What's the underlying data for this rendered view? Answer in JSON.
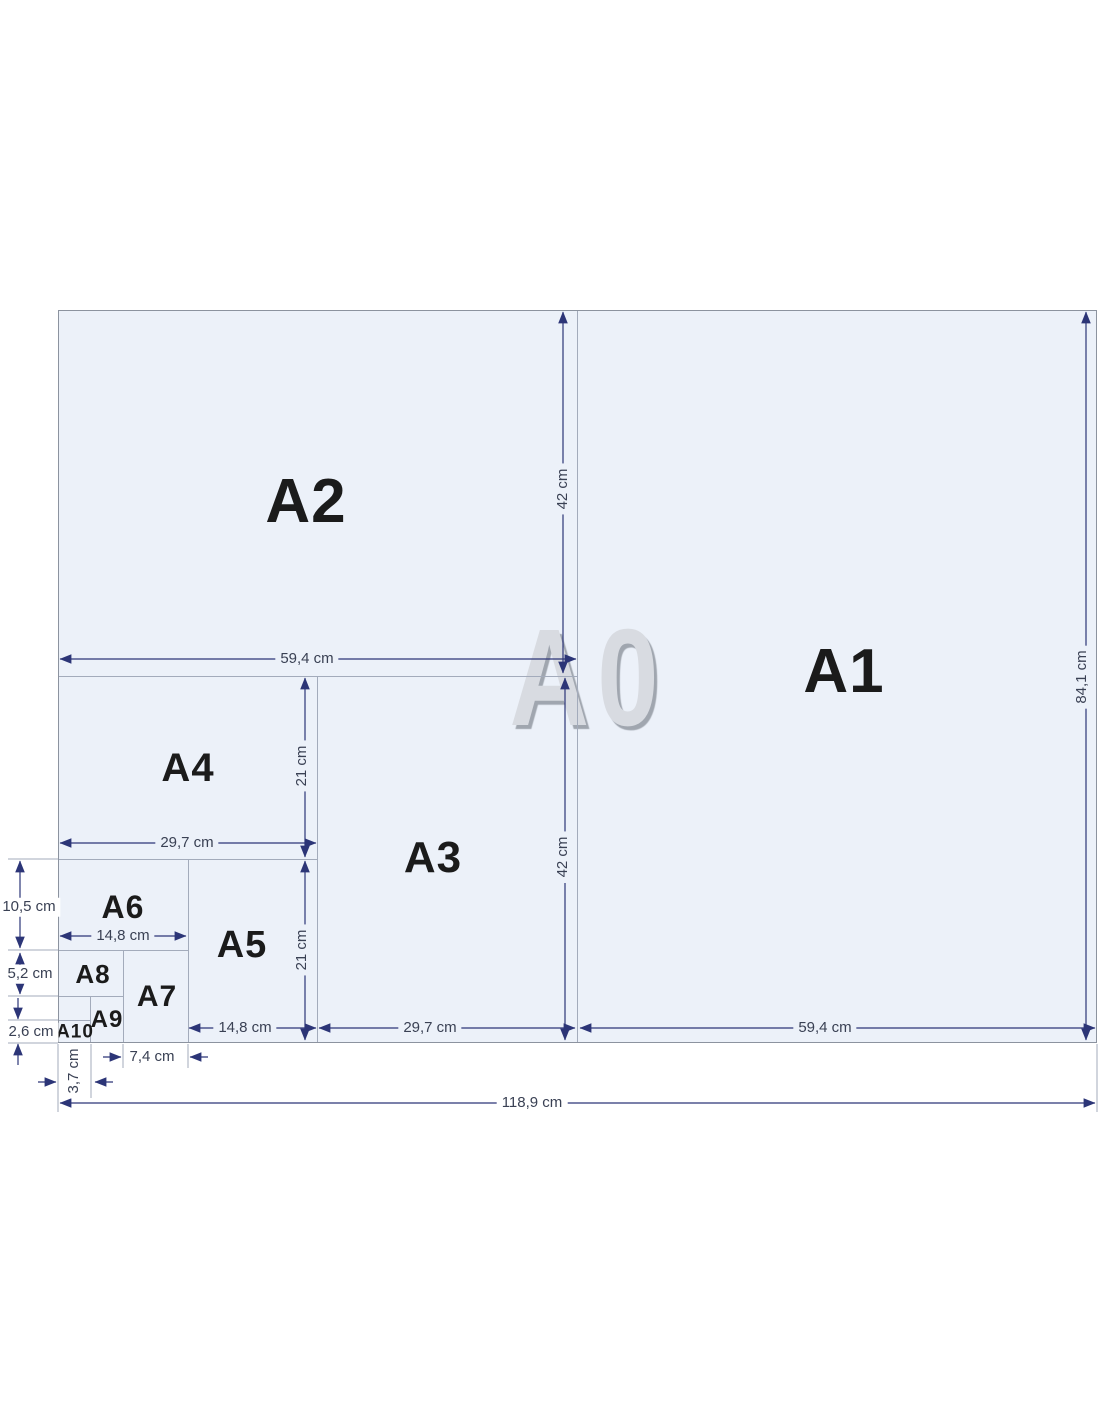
{
  "diagram": {
    "watermark": "A0",
    "regions": [
      {
        "name": "A2",
        "label": "A2"
      },
      {
        "name": "A1",
        "label": "A1"
      },
      {
        "name": "A4",
        "label": "A4"
      },
      {
        "name": "A3",
        "label": "A3"
      },
      {
        "name": "A6",
        "label": "A6"
      },
      {
        "name": "A5",
        "label": "A5"
      },
      {
        "name": "A8",
        "label": "A8"
      },
      {
        "name": "A7",
        "label": "A7"
      },
      {
        "name": "A9",
        "label": "A9"
      },
      {
        "name": "A10",
        "label": "A10"
      }
    ],
    "dims": [
      {
        "name": "a2-width",
        "text": "59,4 cm"
      },
      {
        "name": "a2-height",
        "text": "42 cm"
      },
      {
        "name": "a1-height",
        "text": "84,1 cm"
      },
      {
        "name": "a4-width",
        "text": "29,7 cm"
      },
      {
        "name": "a4-height",
        "text": "21 cm"
      },
      {
        "name": "a3-height",
        "text": "42 cm"
      },
      {
        "name": "a6-height",
        "text": "10,5 cm"
      },
      {
        "name": "a6-width",
        "text": "14,8 cm"
      },
      {
        "name": "a5-height",
        "text": "21 cm"
      },
      {
        "name": "a8-height",
        "text": "5,2 cm"
      },
      {
        "name": "a10-height",
        "text": "2,6 cm"
      },
      {
        "name": "a5-width",
        "text": "14,8 cm"
      },
      {
        "name": "a3-width",
        "text": "29,7 cm"
      },
      {
        "name": "a1-width",
        "text": "59,4 cm"
      },
      {
        "name": "a7-width",
        "text": "7,4 cm"
      },
      {
        "name": "a10-width",
        "text": "3,7 cm"
      },
      {
        "name": "a0-width",
        "text": "118,9 cm"
      }
    ],
    "colors": {
      "sheet_fill": "#ecf1f9",
      "paper_line": "#a3abbb",
      "dimension_line": "#2c3577",
      "dimension_text": "#3a4154",
      "region_label": "#1b1b1b",
      "watermark_fill": "#d8dbe1",
      "watermark_shadow": "#a0a6af"
    }
  }
}
